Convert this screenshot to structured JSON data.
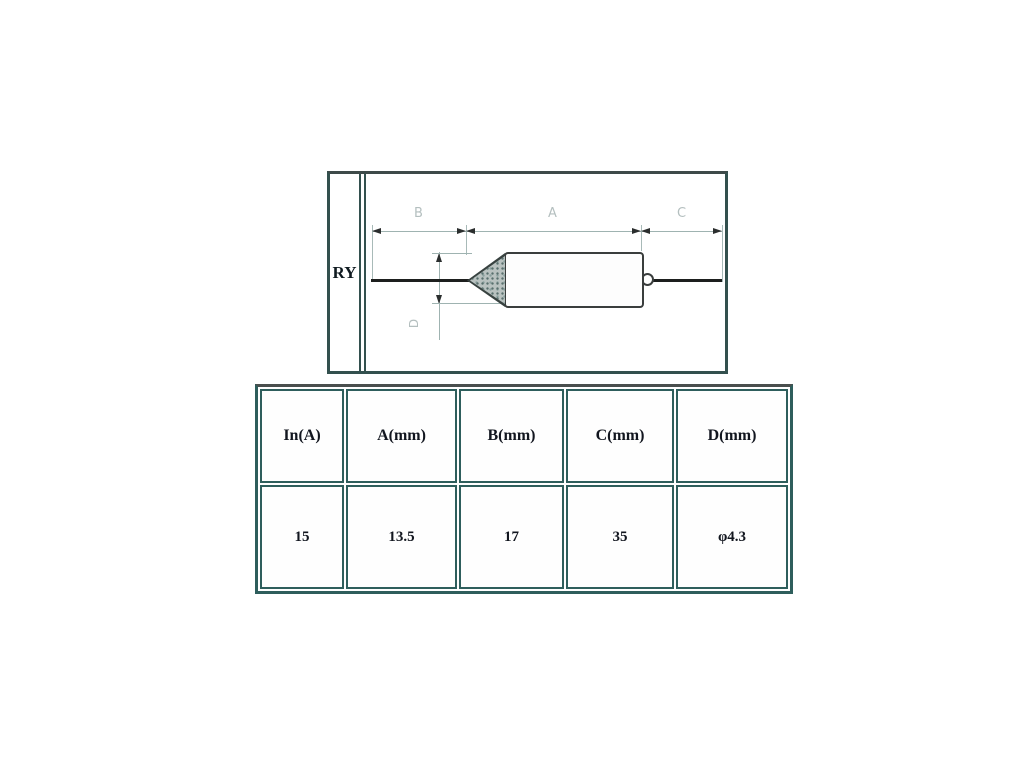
{
  "diagram": {
    "series_label": "RY",
    "dim_top": {
      "b": "B",
      "a": "A",
      "c": "C"
    },
    "dim_side": {
      "d": "D"
    }
  },
  "table": {
    "headers": [
      "In(A)",
      "A(mm)",
      "B(mm)",
      "C(mm)",
      "D(mm)"
    ],
    "values": [
      "15",
      "13.5",
      "17",
      "35",
      "φ4.3"
    ]
  },
  "colors": {
    "table_border": "#2e5e5c",
    "drawing_outline": "#3a3e3d",
    "dimension_gray": "#9fb3b1",
    "text": "#12161f"
  }
}
